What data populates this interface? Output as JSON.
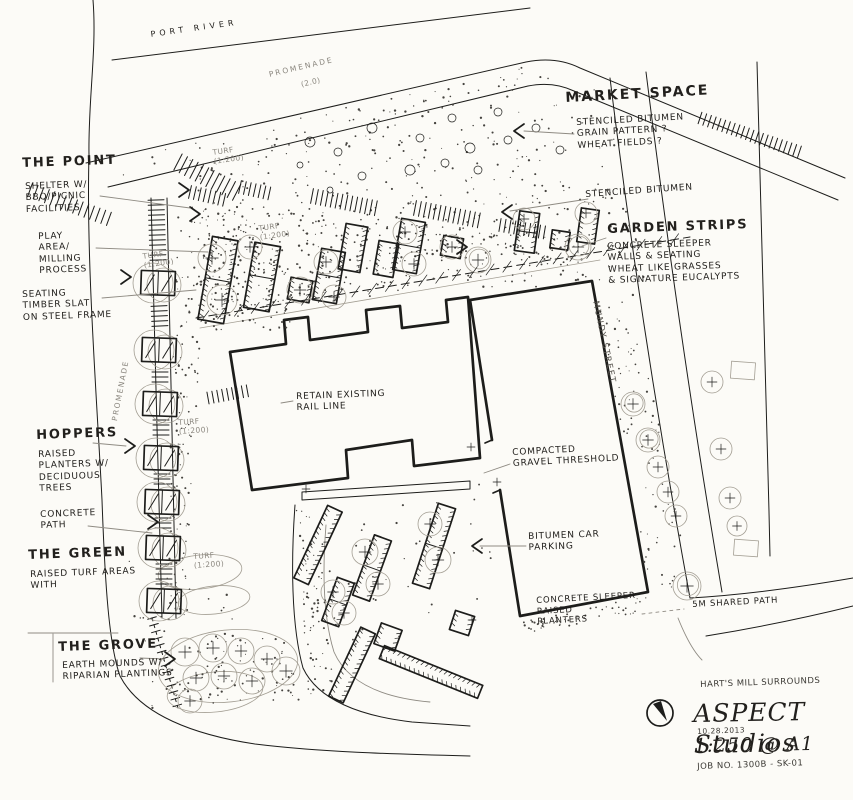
{
  "colors": {
    "paper": "#fcfbf7",
    "ink": "#1d1d1b",
    "pencil": "#a39e93"
  },
  "context": {
    "river": "PORT RIVER",
    "promenade": "PROMENADE",
    "promenade_width": "(2.0)",
    "promenade_left": "PROMENADE",
    "street": "MUNDY STREET",
    "turf": "TURF\n(1:200)"
  },
  "areas": {
    "point": {
      "title": "THE POINT",
      "shelter": "SHELTER W/\nBBQ/PICNIC\nFACILITIES",
      "play": "PLAY\nAREA/\nMILLING\nPROCESS",
      "seating": "SEATING\nTIMBER SLAT\nON STEEL FRAME"
    },
    "market": {
      "title": "MARKET SPACE",
      "stencil": "STENCILED BITUMEN\nGRAIN PATTERN ?\nWHEAT FIELDS ?",
      "stencil2": "STENCILED BITUMEN"
    },
    "garden": {
      "title": "GARDEN STRIPS",
      "note": "CONCRETE SLEEPER\nWALLS & SEATING\nWHEAT LIKE GRASSES\n& SIGNATURE EUCALYPTS"
    },
    "hoppers": {
      "title": "HOPPERS",
      "note": "RAISED\nPLANTERS W/\nDECIDUOUS\nTREES",
      "path": "CONCRETE\nPATH"
    },
    "green": {
      "title": "THE GREEN",
      "note": "RAISED TURF AREAS\nWITH"
    },
    "grove": {
      "title": "THE GROVE",
      "note": "EARTH MOUNDS W/\nRIPARIAN PLANTINGS"
    }
  },
  "notes": {
    "rail": "RETAIN EXISTING\nRAIL LINE",
    "threshold": "COMPACTED\nGRAVEL THRESHOLD",
    "parking": "BITUMEN CAR\nPARKING",
    "planters": "CONCRETE SLEEPER\nRAISED\nPLANTERS",
    "shared": "5M SHARED PATH"
  },
  "titleblock": {
    "project": "HART'S MILL SURROUNDS",
    "firm": "ASPECT Studios",
    "date": "10.28.2013",
    "scale": "1:250 @ A1",
    "job": "JOB NO. 1300B - SK-01"
  }
}
